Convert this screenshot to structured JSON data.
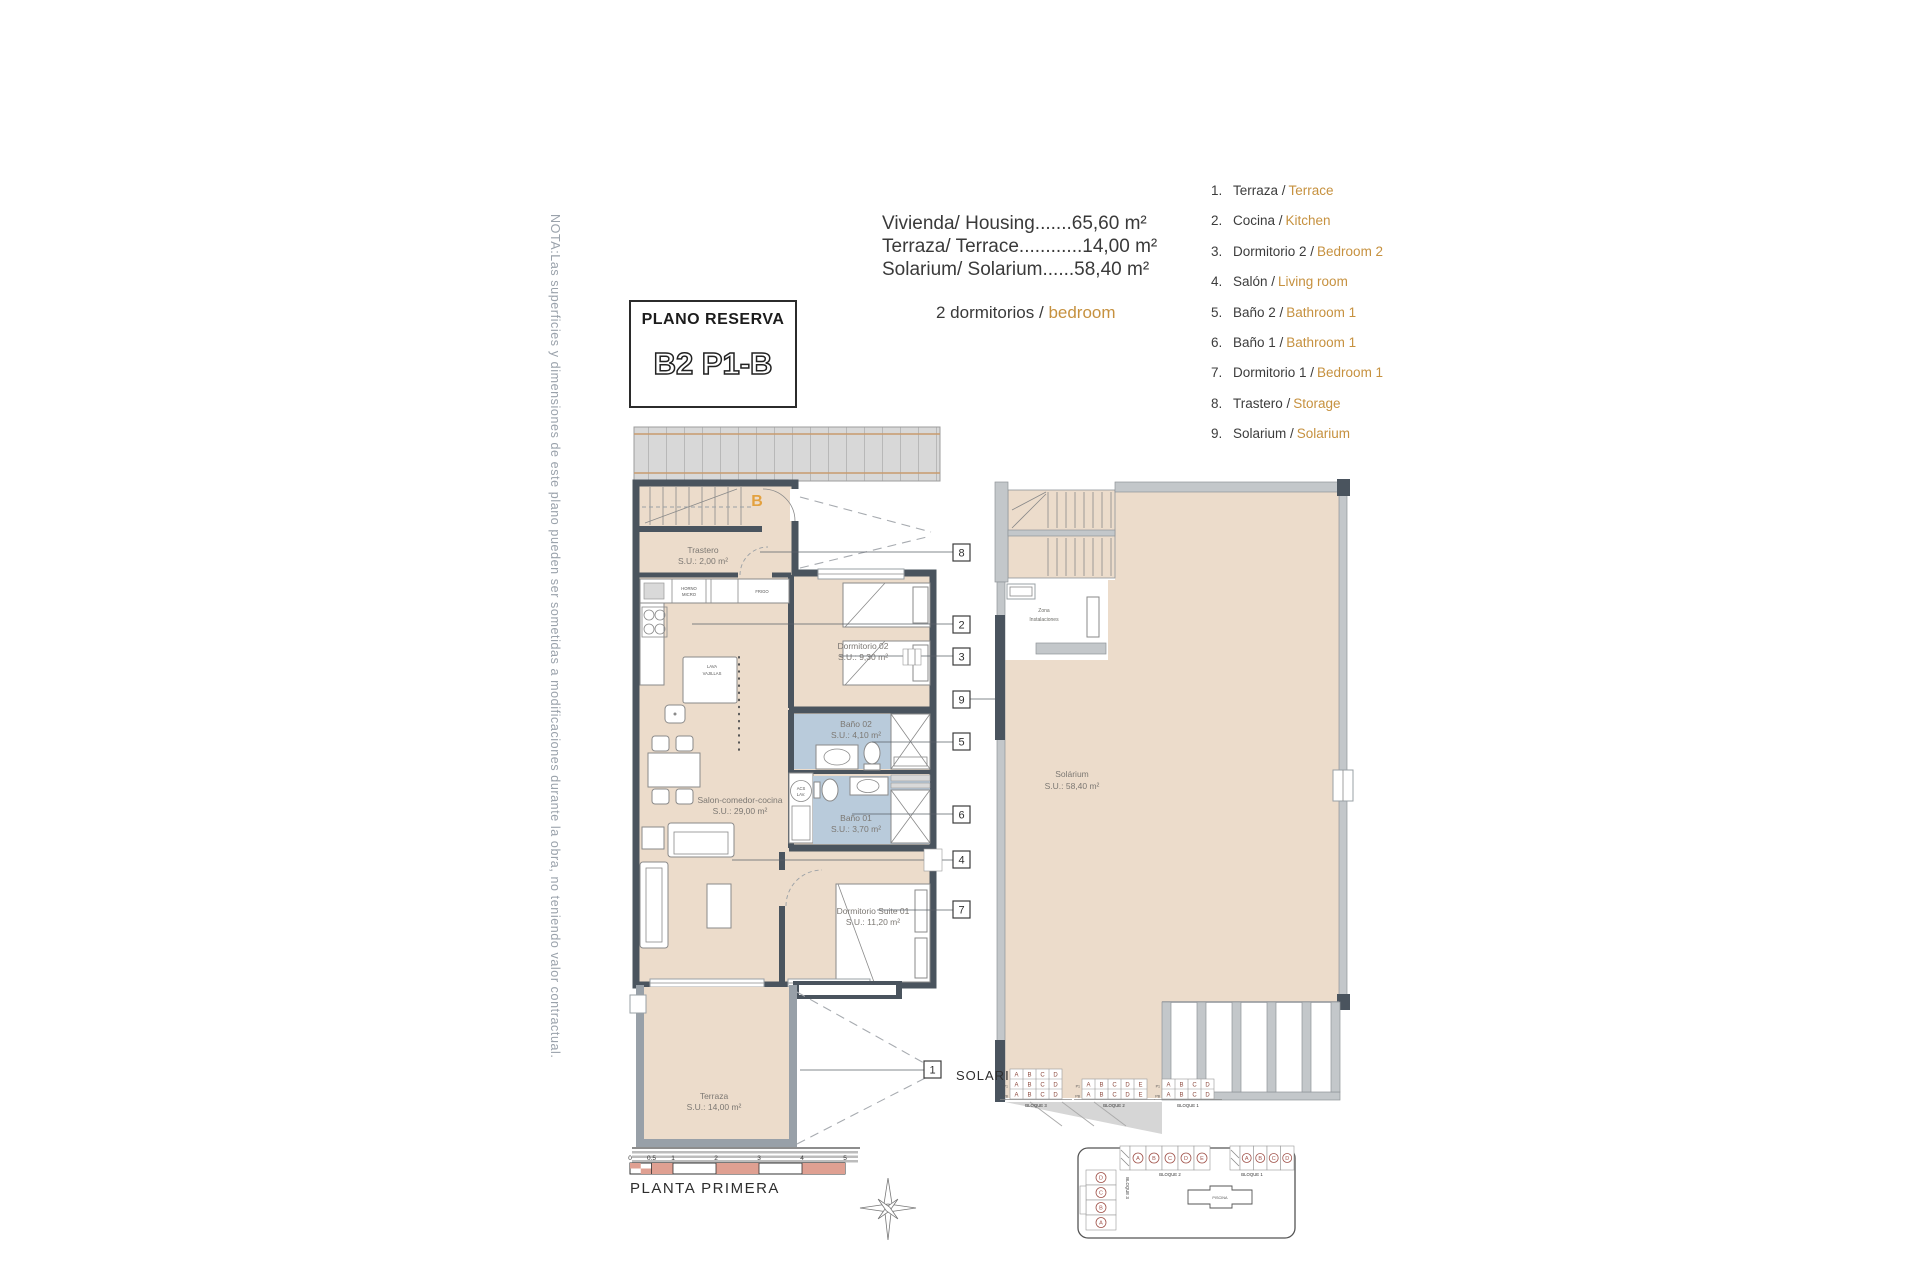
{
  "note": "NOTA:Las superficies y dimensiones de este plano pueden ser sometidas a modificaciones durante la obra, no teniendo valor contractual.",
  "title_block": {
    "subtitle": "PLANO RESERVA",
    "code": "B2 P1-B"
  },
  "areas": {
    "housing": "Vivienda/ Housing.......65,60 m²",
    "terrace": "Terraza/ Terrace............14,00 m²",
    "solarium": "Solarium/ Solarium......58,40 m²",
    "bedrooms_es": "2 dormitorios / ",
    "bedrooms_en": "bedroom"
  },
  "legend": {
    "items": [
      {
        "num": "1.",
        "es": "Terraza / ",
        "en": "Terrace"
      },
      {
        "num": "2.",
        "es": "Cocina / ",
        "en": "Kitchen"
      },
      {
        "num": "3.",
        "es": "Dormitorio 2 / ",
        "en": "Bedroom 2"
      },
      {
        "num": "4.",
        "es": "Salón / ",
        "en": "Living room"
      },
      {
        "num": "5.",
        "es": "Baño 2 / ",
        "en": "Bathroom 1"
      },
      {
        "num": "6.",
        "es": "Baño 1 / ",
        "en": "Bathroom 1"
      },
      {
        "num": "7.",
        "es": "Dormitorio 1 / ",
        "en": "Bedroom 1"
      },
      {
        "num": "8.",
        "es": "Trastero / ",
        "en": "Storage"
      },
      {
        "num": "9.",
        "es": "Solarium / ",
        "en": "Solarium"
      }
    ]
  },
  "rooms": {
    "trastero_name": "Trastero",
    "trastero_area": "S.U.: 2,00 m²",
    "dorm2_name": "Dormitorio 02",
    "dorm2_area": "S.U.: 9,30 m²",
    "bano2_name": "Baño 02",
    "bano2_area": "S.U.: 4,10 m²",
    "bano1_name": "Baño 01",
    "bano1_area": "S.U.: 3,70 m²",
    "salon_name": "Salon-comedor-cocina",
    "salon_area": "S.U.: 29,00 m²",
    "suite_name": "Dormitorio Suite 01",
    "suite_area": "S.U.: 11,20 m²",
    "terraza_name": "Terraza",
    "terraza_area": "S.U.: 14,00 m²",
    "solarium_name": "Solárium",
    "solarium_area": "S.U.: 58,40 m²",
    "zona_l1": "Zona",
    "zona_l2": "Instalaciones"
  },
  "plan_marks": {
    "entrance_letter": "B",
    "horno": "HORNO",
    "micro": "MICRO",
    "frigo": "FRIGO",
    "lava1": "LAVA",
    "lava2": "VAJILLAS",
    "acs1": "ACS",
    "acs2": "LAV."
  },
  "callouts": {
    "n1": "1",
    "n2": "2",
    "n3": "3",
    "n4": "4",
    "n5": "5",
    "n6": "6",
    "n7": "7",
    "n8": "8",
    "n9": "9"
  },
  "scale": {
    "t0": "0",
    "t05": "0.5",
    "t1": "1",
    "t2": "2",
    "t3": "3",
    "t4": "4",
    "t5": "5"
  },
  "plan_title": "PLANTA PRIMERA",
  "solarium_section_label": "SOLARIUM",
  "tables": {
    "b3": {
      "label": "BLOQUE 3",
      "p1": "P1",
      "pb": "PB",
      "row_s": [
        "A",
        "B",
        "C",
        "D"
      ],
      "row_p1": [
        "A",
        "B",
        "C",
        "D"
      ],
      "row_pb": [
        "A",
        "B",
        "C",
        "D"
      ]
    },
    "b2": {
      "label": "BLOQUE 2",
      "p1": "P1",
      "pb": "PB",
      "row_p1": [
        "A",
        "B",
        "C",
        "D",
        "E"
      ],
      "row_pb": [
        "A",
        "B",
        "C",
        "D",
        "E"
      ]
    },
    "b1": {
      "label": "BLOQUE 1",
      "p1": "P1",
      "pb": "PB",
      "row_p1": [
        "A",
        "B",
        "C",
        "D"
      ],
      "row_pb": [
        "A",
        "B",
        "C",
        "D"
      ]
    }
  },
  "siteplan": {
    "b3_label": "BLOQUE 3",
    "b3_units": [
      "D",
      "C",
      "B",
      "A"
    ],
    "b2_label": "BLOQUE 2",
    "b2_units": [
      "A",
      "B",
      "C",
      "D",
      "E"
    ],
    "b1_label": "BLOQUE 1",
    "b1_units": [
      "A",
      "B",
      "C",
      "D"
    ],
    "piscina": "PISCINA"
  },
  "colors": {
    "accent_orange": "#c6913f",
    "wall_dark": "#4a545e",
    "floor_beige": "#ecdccb",
    "bath_blue": "#b9cbdb",
    "highlight_pink": "#f2a99c",
    "scale_salmon": "#dfa092",
    "table_letter_red": "#8d4a3e"
  }
}
